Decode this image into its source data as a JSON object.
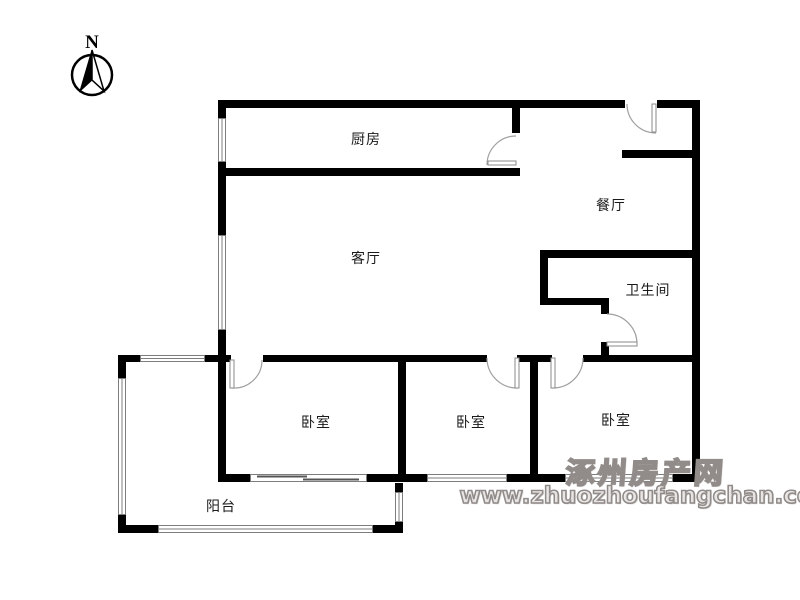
{
  "compass": {
    "label": "N"
  },
  "rooms": [
    {
      "name": "kitchen",
      "label": "厨房"
    },
    {
      "name": "dining-room",
      "label": "餐厅"
    },
    {
      "name": "living-room",
      "label": "客厅"
    },
    {
      "name": "bathroom",
      "label": "卫生间"
    },
    {
      "name": "bedroom-left",
      "label": "卧室"
    },
    {
      "name": "bedroom-middle",
      "label": "卧室"
    },
    {
      "name": "bedroom-right",
      "label": "卧室"
    },
    {
      "name": "balcony",
      "label": "阳台"
    }
  ],
  "watermark": {
    "site_name": "涿州房产网",
    "site_url": "www.zhuozhoufangchan.com"
  },
  "colors": {
    "wall": "#000000",
    "door_arc": "#a0a0a0",
    "window_line": "#7d7d7d",
    "watermark_gray": "#918c89",
    "text": "#1a1a1a",
    "background": "#ffffff"
  }
}
